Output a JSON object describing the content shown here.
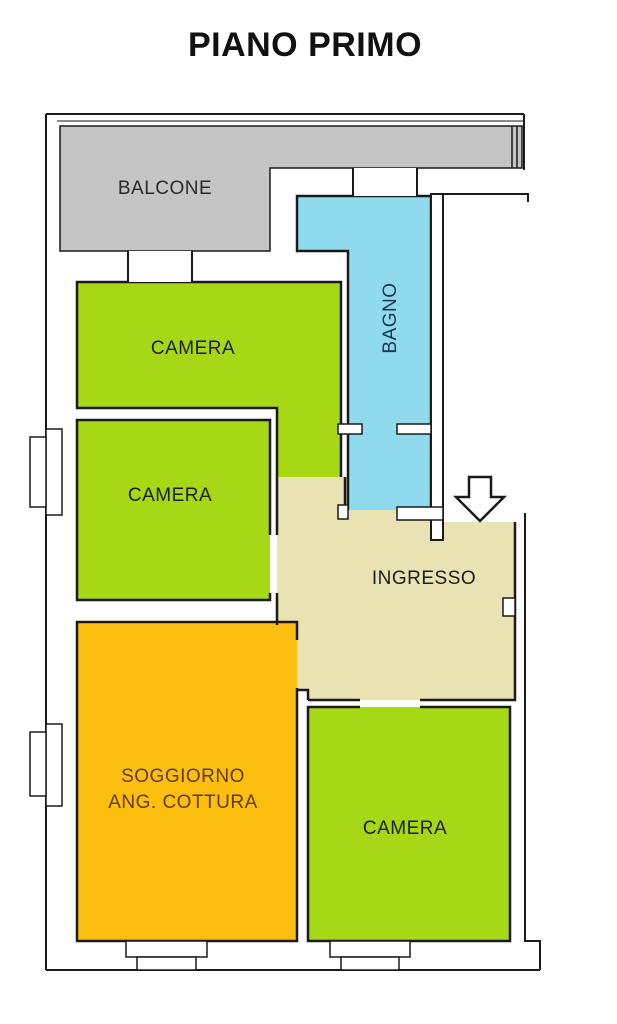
{
  "title": "PIANO PRIMO",
  "colors": {
    "wall": "#1a1a1a",
    "background": "#ffffff"
  },
  "rooms": {
    "balcone": {
      "label": "BALCONE",
      "color": "#c5c5c5",
      "label_color": "#2a2a2a"
    },
    "camera1": {
      "label": "CAMERA",
      "color": "#a6d816",
      "label_color": "#1d1d1d"
    },
    "camera2": {
      "label": "CAMERA",
      "color": "#a6d816",
      "label_color": "#1d1d1d"
    },
    "bagno": {
      "label": "BAGNO",
      "color": "#8fdaec",
      "label_color": "#16375a"
    },
    "ingresso": {
      "label": "INGRESSO",
      "color": "#e9e2b2",
      "label_color": "#1d1d1d"
    },
    "soggiorno": {
      "label_line1": "SOGGIORNO",
      "label_line2": "ANG. COTTURA",
      "color": "#fcbf0f",
      "label_color": "#653a0e"
    },
    "camera3": {
      "label": "CAMERA",
      "color": "#a6d816",
      "label_color": "#1d1d1d"
    }
  },
  "entrance_arrow": {
    "direction": "down"
  }
}
